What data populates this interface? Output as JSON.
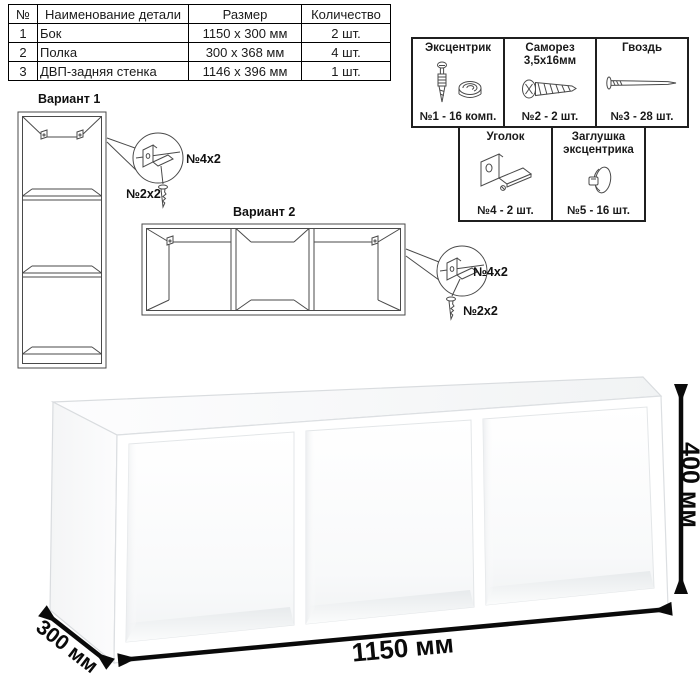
{
  "parts_table": {
    "headers": [
      "№",
      "Наименование детали",
      "Размер",
      "Количество"
    ],
    "rows": [
      {
        "num": "1",
        "name": "Бок",
        "size": "1150 х 300 мм",
        "qty": "2 шт."
      },
      {
        "num": "2",
        "name": "Полка",
        "size": "300 х 368 мм",
        "qty": "4 шт."
      },
      {
        "num": "3",
        "name": "ДВП-задняя стенка",
        "size": "1146 х 396 мм",
        "qty": "1 шт."
      }
    ]
  },
  "hardware": {
    "items": [
      {
        "title": "Эксцентрик",
        "count": "№1 - 16 комп.",
        "icon": "eccentric-cam-icon"
      },
      {
        "title": "Саморез 3,5х16мм",
        "count": "№2 - 2 шт.",
        "icon": "screw-icon"
      },
      {
        "title": "Гвоздь",
        "count": "№3 - 28 шт.",
        "icon": "nail-icon"
      },
      {
        "title": "Уголок",
        "count": "№4 - 2 шт.",
        "icon": "corner-bracket-icon"
      },
      {
        "title": "Заглушка эксцентрика",
        "count": "№5 - 16 шт.",
        "icon": "cam-cap-icon"
      }
    ]
  },
  "variants": {
    "variant1": {
      "label": "Вариант 1",
      "bracket_label": "№4х2",
      "screw_label": "№2х2"
    },
    "variant2": {
      "label": "Вариант 2",
      "bracket_label": "№4х2",
      "screw_label": "№2х2"
    }
  },
  "dimensions": {
    "width": "1150 мм",
    "depth": "300 мм",
    "height": "400 мм"
  },
  "colors": {
    "line_art": "#4a4a4a",
    "dimension": "#0a0a0a",
    "table_border": "#000000"
  }
}
